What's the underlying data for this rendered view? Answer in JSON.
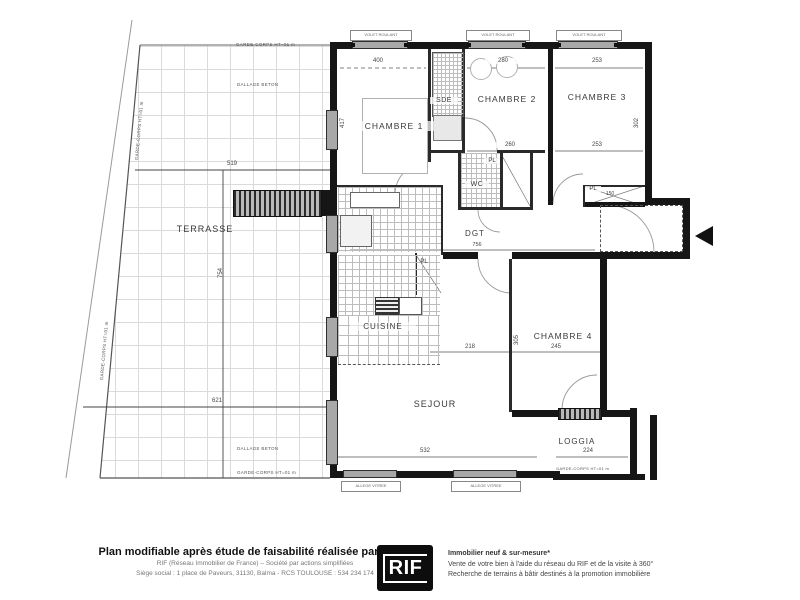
{
  "plan": {
    "rooms": {
      "terrasse": "TERRASSE",
      "chambre1": "CHAMBRE 1",
      "sde": "SDE",
      "chambre2": "CHAMBRE 2",
      "chambre3": "CHAMBRE 3",
      "chambre4": "CHAMBRE 4",
      "wc": "WC",
      "pl_wc": "PL",
      "pl_hall": "PL",
      "pl_chambre3": "PL",
      "dgt": "DGT",
      "cuisine": "CUISINE",
      "sejour": "SEJOUR",
      "loggia": "LOGGIA"
    },
    "dims": {
      "terrasse_top": "519",
      "terrasse_bottom": "621",
      "terrasse_height": "754",
      "chambre1_w": "400",
      "chambre1_h": "417",
      "chambre2_w": "280",
      "chambre2_w2": "260",
      "chambre3_w_top": "253",
      "chambre3_w_bottom": "253",
      "chambre3_h": "302",
      "pl_chambre3_w": "150",
      "dgt_l": "756",
      "chambre4_w": "245",
      "chambre4_h": "305",
      "sejour_opening": "218",
      "sejour_w": "532",
      "loggia_w": "224"
    },
    "notes": {
      "garde_corps": "GARDE-CORPS HT=01 m",
      "dallage_beton": "DALLAGE BETON",
      "volet": "VOLET ROULANT",
      "allege": "ALLEGE VITREE"
    }
  },
  "footer": {
    "title": "Plan modifiable après étude de faisabilité réalisée par le RIF",
    "line2": "RIF (Réseau Immobilier de France) – Société par actions simplifiées",
    "line3": "Siège social : 1 place de Paveurs, 31130, Balma - RCS TOULOUSE : 534 234 174",
    "logo": "RIF",
    "right1": "Immobilier neuf & sur-mesure*",
    "right2": "Vente de votre bien à l'aide du réseau du RIF et de la visite à 360°",
    "right3": "Recherche de terrains à bâtir destinés à la promotion immobilière"
  },
  "colors": {
    "wall": "#161616",
    "tile_line": "#bdbdbd",
    "window_gray": "#a8a8a8",
    "background": "#ffffff"
  }
}
